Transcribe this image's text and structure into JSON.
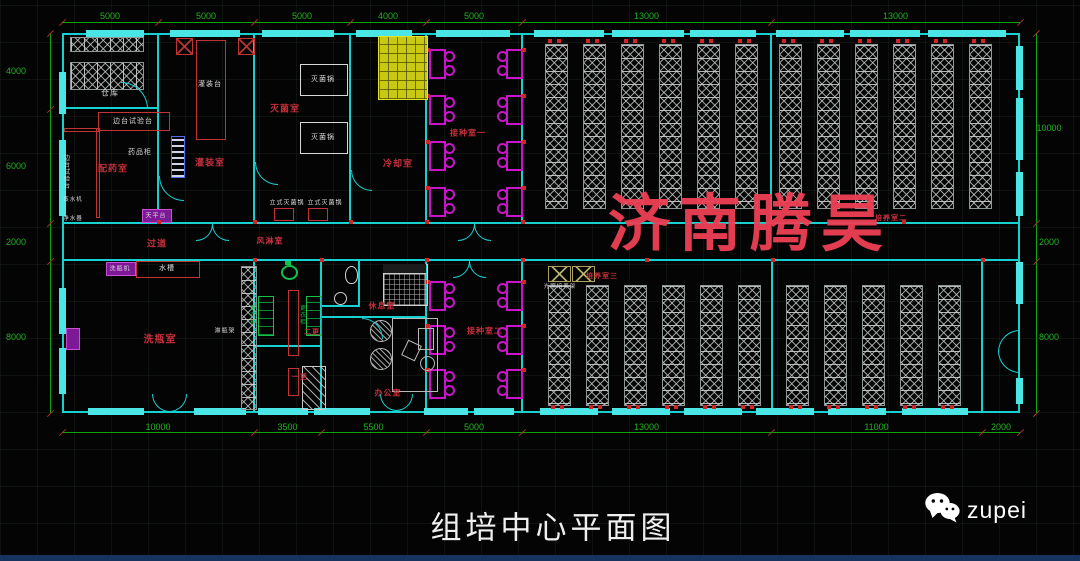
{
  "watermark_text": "济南腾昊",
  "footer": {
    "title": "组培中心平面图",
    "brand": "zupei"
  },
  "dims": {
    "top": [
      "5000",
      "5000",
      "5000",
      "4000",
      "5000",
      "13000",
      "13000"
    ],
    "bottom": [
      "10000",
      "3500",
      "5500",
      "5000",
      "13000",
      "11000",
      "2000"
    ],
    "left": [
      "4000",
      "6000",
      "2000",
      "8000"
    ],
    "right": [
      "10000",
      "2000",
      "8000"
    ]
  },
  "labels": {
    "cangku": "仓库",
    "biantai": "边台试验台",
    "yaopingui": "药品柜",
    "peiyaoshi": "配药室",
    "guanzhuangtai": "灌装台",
    "guanzhuangshi": "灌装室",
    "tianpingtai": "天平台",
    "miejunshi": "灭菌室",
    "miejunguo": "灭菌锅",
    "lengqueshi": "冷却室",
    "lishimiejunguo": "立式灭菌锅",
    "fenglinshi": "风淋室",
    "guodao": "过道",
    "zhengshuiji": "蒸水机",
    "jingshuiji": "净水器",
    "xipingji": "洗瓶机",
    "shuicao": "水槽",
    "xipingshi": "洗瓶室",
    "linpingjia": "淋瓶架",
    "gengyigui": "更衣柜",
    "ergeng": "二更",
    "yigeng": "一更",
    "xiuxishi": "休息室",
    "bangongshi": "办公室",
    "jiezhong1": "接种室一",
    "jiezhong2": "接种室二",
    "peiyang2": "培养室二",
    "peiyang3": "培养室三",
    "guangzhao": "光照培养架"
  }
}
